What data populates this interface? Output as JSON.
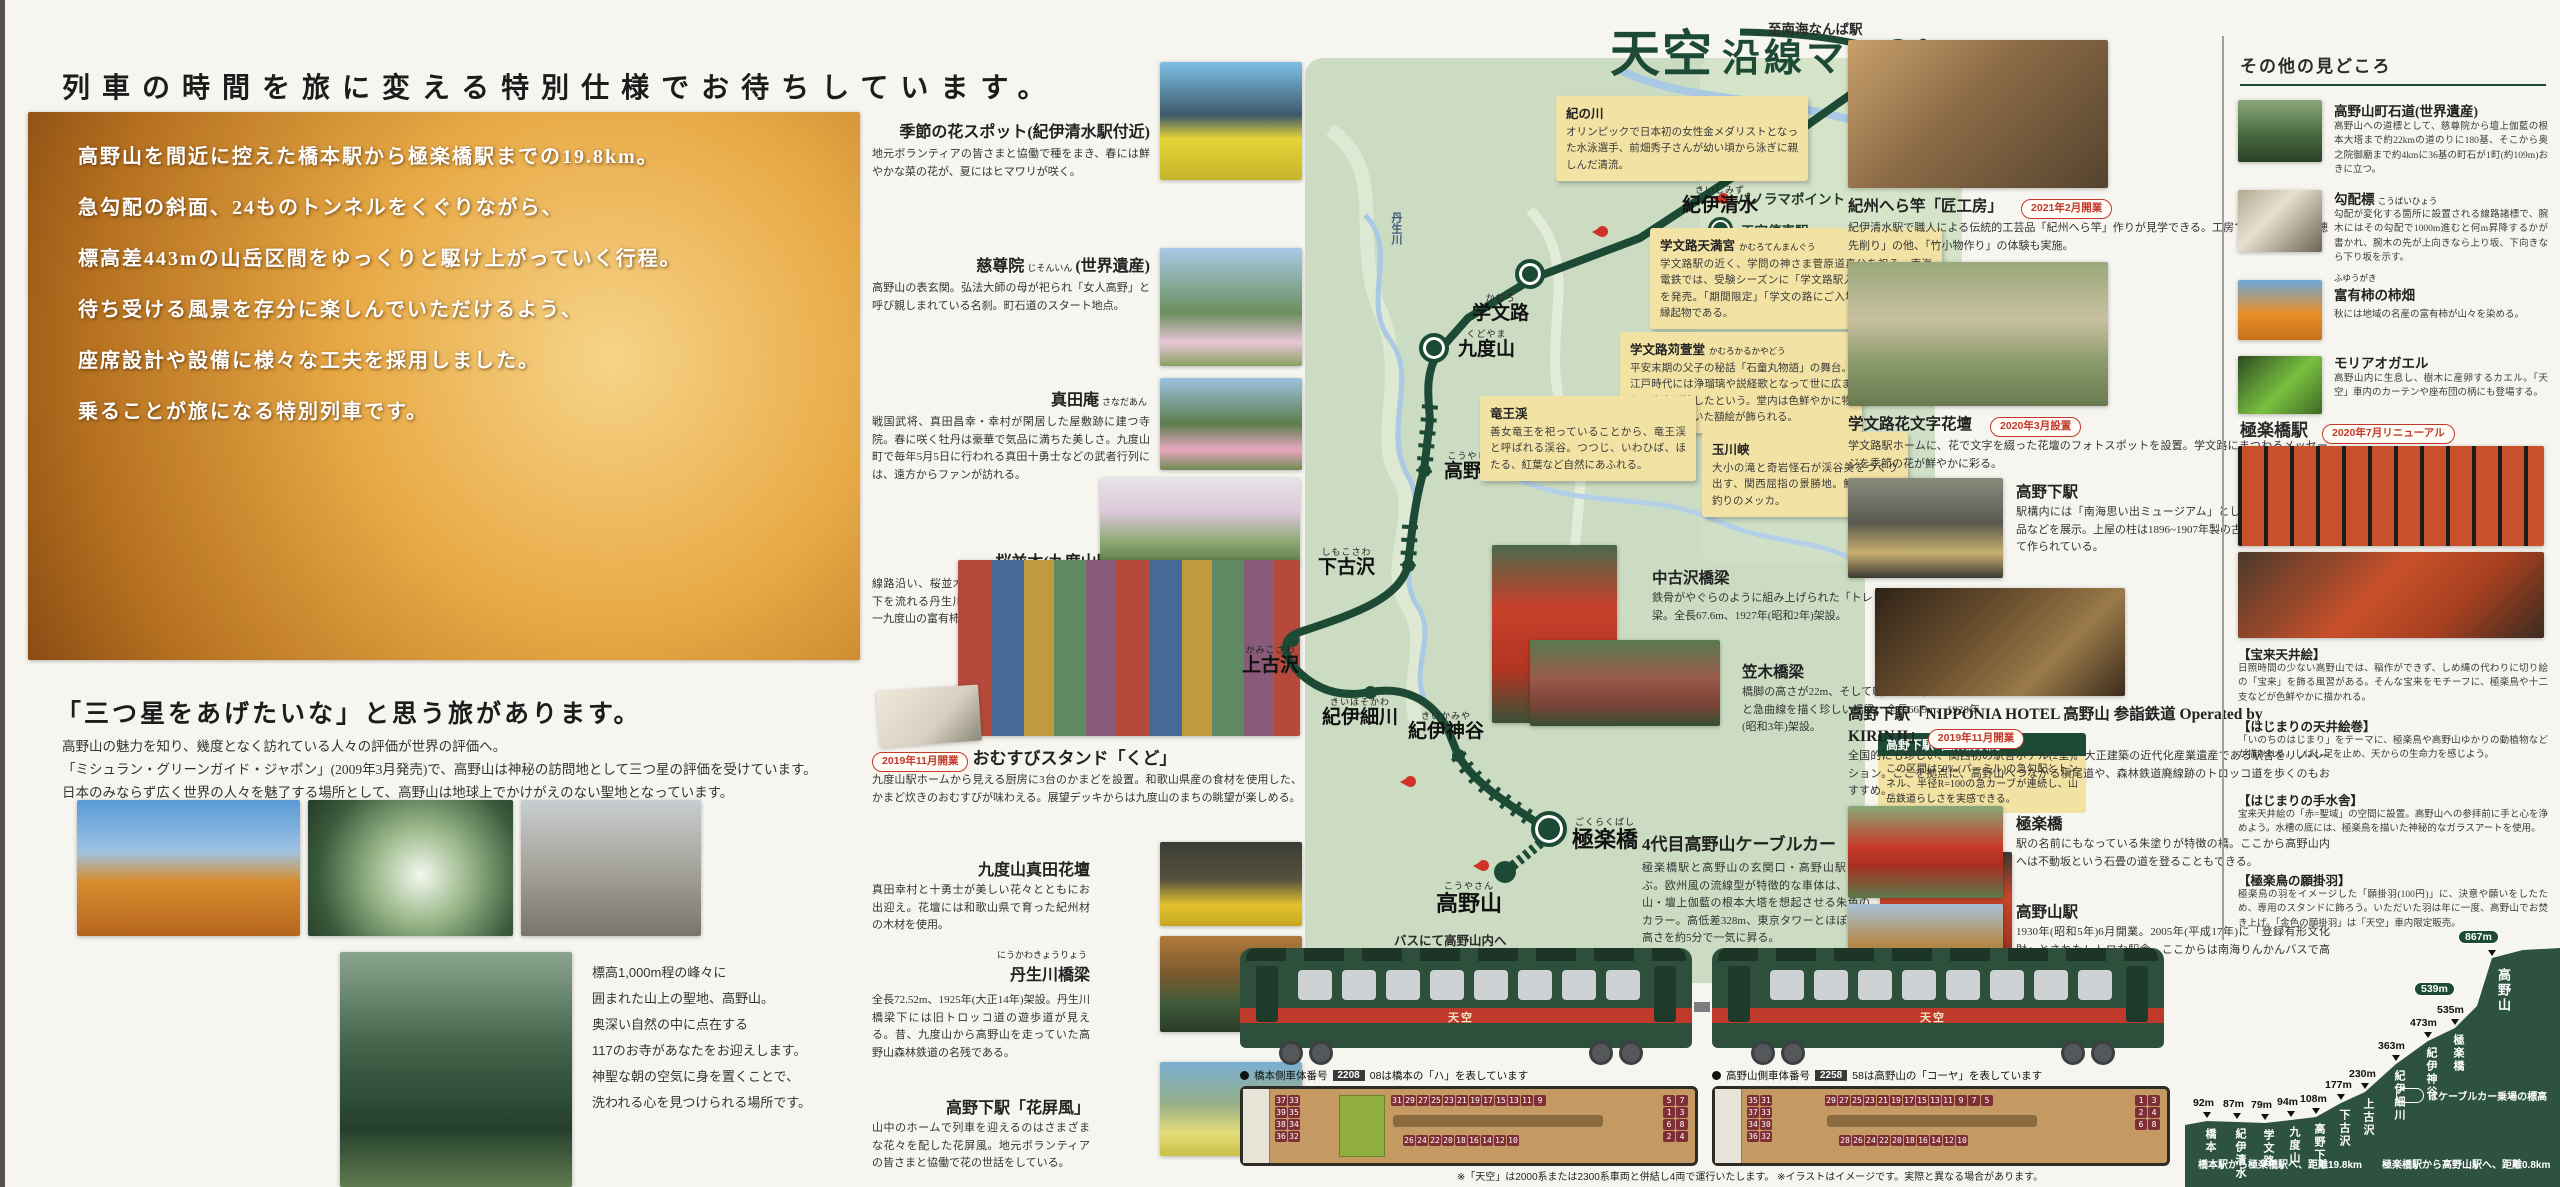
{
  "left": {
    "headline": "列車の時間を旅に変える特別仕様でお待ちしています。",
    "intro_lines": [
      "高野山を間近に控えた橋本駅から極楽橋駅までの19.8km。",
      "急勾配の斜面、24ものトンネルをくぐりながら、",
      "標高差443mの山岳区間をゆっくりと駆け上がっていく行程。",
      "待ち受ける風景を存分に楽しんでいただけるよう、",
      "座席設計や設備に様々な工夫を採用しました。",
      "乗ることが旅になる特別列車です。"
    ],
    "michelin_title": "「三つ星をあげたいな」と思う旅があります。",
    "michelin_lines": [
      "高野山の魅力を知り、幾度となく訪れている人々の評価が世界の評価へ。",
      "「ミシュラン・グリーンガイド・ジャポン」(2009年3月発売)で、高野山は神秘の訪問地として三つ星の評価を受けています。",
      "日本のみならず広く世界の人々を魅了する場所として、高野山は地球上でかけがえのない聖地となっています。"
    ],
    "koyasan_note_lines": [
      "標高1,000m程の峰々に",
      "囲まれた山上の聖地、高野山。",
      "奥深い自然の中に点在する",
      "117のお寺があなたをお迎えします。",
      "神聖な朝の空気に身を置くことで、",
      "洗われる心を見つけられる場所です。"
    ]
  },
  "spots": {
    "items": [
      {
        "kana": "",
        "title": "季節の花スポット(紀伊清水駅付近)",
        "suffix": "",
        "badge": "",
        "body": "地元ボランティアの皆さまと協働で種をまき、春には鮮やかな菜の花が、夏にはヒマワリが咲く。"
      },
      {
        "kana": "じそんいん",
        "title": "慈尊院",
        "suffix": "(世界遺産)",
        "badge": "",
        "body": "高野山の表玄関。弘法大師の母が祀られ「女人高野」と呼び親しまれている名刹。町石道のスタート地点。"
      },
      {
        "kana": "さなだあん",
        "title": "真田庵",
        "suffix": "",
        "badge": "",
        "body": "戦国武将、真田昌幸・幸村が閑居した屋敷跡に建つ寺院。春に咲く牡丹は豪華で気品に満ちた美しさ。九度山町で毎年5月5日に行われる真田十勇士などの武者行列には、遠方からファンが訪れる。"
      },
      {
        "kana": "",
        "title": "桜並木(九度山駅付近)",
        "suffix": "",
        "badge": "",
        "body": "線路沿い、桜並木が車窓をうめ尽くす。眼下を流れる丹生川対岸の町役場には「日本一九度山の富有柿」の看板が見える。"
      },
      {
        "kana": "",
        "title": "おむすびスタンド「くど」",
        "suffix": "",
        "badge": "2019年11月開業",
        "body": "九度山駅ホームから見える厨房に3台のかまどを設置。和歌山県産の食材を使用した、かまど炊きのおむすびが味わえる。展望デッキからは九度山のまちの眺望が楽しめる。"
      },
      {
        "kana": "",
        "title": "九度山真田花壇",
        "suffix": "",
        "badge": "",
        "body": "真田幸村と十勇士が美しい花々とともにお出迎え。花壇には和歌山県で育った紀州材の木材を使用。"
      },
      {
        "kana": "にうかわきょうりょう",
        "title": "丹生川橋梁",
        "suffix": "",
        "badge": "",
        "body": "全長72.52m、1925年(大正14年)架設。丹生川橋梁下には旧トロッコ道の遊歩道が見える。昔、九度山から高野山を走っていた高野山森林鉄道の名残である。"
      },
      {
        "kana": "",
        "title": "高野下駅「花屏風」",
        "suffix": "",
        "badge": "",
        "body": "山中のホームで列車を迎えるのはさまざまな花々を配した花屏風。地元ボランティアの皆さまと協働で花の世話をしている。"
      }
    ]
  },
  "map": {
    "logo": "天空",
    "title": "沿線マップ",
    "to_namba": "至南海なんば駅",
    "river": "丹生川",
    "bus_note": "バスにて高野山内へ",
    "legend": {
      "panorama": "パノラマポイント",
      "station": "天空停車駅",
      "tunnel": "トンネル"
    },
    "stations": [
      {
        "name": "橋本",
        "kana": "はしもと"
      },
      {
        "name": "紀伊清水",
        "kana": "きいしみず"
      },
      {
        "name": "学文路",
        "kana": "かむろ"
      },
      {
        "name": "九度山",
        "kana": "くどやま"
      },
      {
        "name": "高野下",
        "kana": "こうやした"
      },
      {
        "name": "下古沢",
        "kana": "しもこさわ"
      },
      {
        "name": "上古沢",
        "kana": "かみこさわ"
      },
      {
        "name": "紀伊細川",
        "kana": "きいほそかわ"
      },
      {
        "name": "紀伊神谷",
        "kana": "きいかみや"
      },
      {
        "name": "極楽橋",
        "kana": "ごくらくばし"
      },
      {
        "name": "高野山",
        "kana": "こうやさん"
      }
    ],
    "callouts": [
      {
        "title": "紀の川",
        "kana": "",
        "body": "オリンピックで日本初の女性金メダリストとなった水泳選手、前畑秀子さんが幼い頃から泳ぎに親しんだ清流。"
      },
      {
        "title": "学文路天満宮",
        "kana": "かむろてんまんぐう",
        "body": "学文路駅の近く、学問の神さま菅原道真公を祀る。南海電鉄では、受験シーズンに「学文路駅入場券」(5枚入り)を発売。「期間限定」「学文の路にご入場」と語呂のいい縁起物である。"
      },
      {
        "title": "学文路苅萱堂",
        "kana": "かむろかるかやどう",
        "body": "平安末期の父子の秘話「石童丸物語」の舞台。江戸時代には浄瑠璃や説経歌となって世に広まり、大衆が涙したという。堂内は色鮮やかに物語の世界を描いた額絵が飾られる。"
      },
      {
        "title": "竜王渓",
        "kana": "",
        "body": "善女竜王を祀っていることから、竜王渓と呼ばれる渓谷。つつじ、いわひば、ほたる、紅葉など自然にあふれる。"
      },
      {
        "title": "玉川峡",
        "kana": "",
        "body": "大小の滝と奇岩怪石が渓谷美をつくり出す、関西屈指の景勝地。鮎、アマゴ釣りのメッカ。"
      }
    ],
    "section_box": {
      "title": "高野下駅~極楽橋駅間",
      "body": "この区間は50‰(パーミル)の急勾配とトンネル、半径R=100の急カーブが連続し、山岳鉄道らしさを実感できる。"
    },
    "bridges": [
      {
        "title": "中古沢橋梁",
        "body": "鉄骨がやぐらのように組み上げられた「トレッスル式橋脚」の橋梁。全長67.6m、1927年(昭和2年)架設。"
      },
      {
        "title": "笠木橋梁",
        "body": "橋脚の高さが22m、そして軌道が曲線半径R=123と急曲線を描く珍しい橋梁。全長66.9m、1928年(昭和3年)架設。"
      }
    ],
    "cable_car": {
      "badge": "2019年3月デビュー",
      "title": "4代目高野山ケーブルカー",
      "body": "極楽橋駅と高野山の玄関口・高野山駅を結ぶ。欧州風の流線型が特徴的な車体は、高野山・壇上伽藍の根本大塔を想起させる朱色のカラー。高低差328m、東京タワーとほぼ同じ高さを約5分で一気に昇る。"
    }
  },
  "right_col": {
    "items": [
      {
        "title": "紀州へら竿「匠工房」",
        "badge": "2021年2月開業",
        "body": "紀伊清水駅で職人による伝統的工芸品「紀州へら竿」作りが見学できる。工房では「火入れ」「穂先削り」の他、「竹小物作り」の体験も実施。"
      },
      {
        "title": "学文路花文字花壇",
        "badge": "2020年3月設置",
        "body": "学文路駅ホームに、花で文字を綴った花壇のフォトスポットを設置。学文路にまつわるメッセージを季節の花が鮮やかに彩る。"
      },
      {
        "title": "高野下駅",
        "badge": "",
        "body": "駅構内には「南海思い出ミュージアム」として、秘蔵の鉄道部品などを展示。上屋の柱は1896~1907年製の古レールを再利用して作られている。"
      },
      {
        "title": "高野下駅「NIPPONIA HOTEL 高野山 参詣鉄道 Operated by KIRINJI」",
        "badge": "2019年11月開業",
        "body": "全国的にも珍しい、関西初の駅舎ホテル(2室)。大正建築の近代化産業遺産である駅舎をリノベーション。ここを拠点に、高野山へつながる槇尾道や、森林鉄道廃線跡のトロッコ道を歩くのもおすすめ。"
      },
      {
        "title": "極楽橋",
        "badge": "",
        "body": "駅の名前にもなっている朱塗りが特徴の橋。ここから高野山内へは不動坂という石畳の道を登ることもできる。"
      },
      {
        "title": "高野山駅",
        "badge": "",
        "body": "1930年(昭和5年)6月開業。2005年(平成17年)に「登録有形文化財」とされたレトロな駅舎。ここからは南海りんかんバスで高野山内へ。"
      }
    ]
  },
  "misc": {
    "header": "その他の見どころ",
    "items": [
      {
        "title": "高野山町石道(世界遺産)",
        "kana": "",
        "body": "高野山への道標として、慈尊院から壇上伽藍の根本大塔まで約22kmの道のりに180基、そこから奥之院御廟まで約4kmに36基の町石が1町(約109m)おきに立つ。"
      },
      {
        "title": "勾配標",
        "kana": "こうばいひょう",
        "body": "勾配が変化する箇所に設置される線路諸標で、腕木にはその勾配で1000m進むと何m昇降するかが書かれ、腕木の先が上向きなら上り坂、下向きなら下り坂を示す。"
      },
      {
        "title": "富有柿の柿畑",
        "kana": "ふゆうがき",
        "body": "秋には地域の名産の富有柿が山々を染める。"
      },
      {
        "title": "モリアオガエル",
        "kana": "",
        "body": "高野山内に生息し、樹木に産卵するカエル。「天空」車内のカーテンや座布団の柄にも登場する。"
      }
    ],
    "gokurakubashi": {
      "title": "極楽橋駅",
      "badge": "2020年7月リニューアル",
      "sections": [
        {
          "title": "【宝来天井絵】",
          "body": "日照時間の少ない高野山では、稲作ができず、しめ縄の代わりに切り絵の「宝来」を飾る風習がある。そんな宝来をモチーフに、極楽鳥や十二支などが色鮮やかに描かれる。"
        },
        {
          "title": "【はじまりの天井絵巻】",
          "body": "「いのちのはじまり」をテーマに、極楽鳥や高野山ゆかりの動植物などが描かれる。しばし足を止め、天からの生命力を感じよう。"
        },
        {
          "title": "【はじまりの手水舎】",
          "body": "宝来天井絵の「赤=聖域」の空間に設置。高野山への参拝前に手と心を浄めよう。水槽の底には、極楽鳥を描いた神秘的なガラスアートを使用。"
        },
        {
          "title": "【極楽鳥の願掛羽】",
          "body": "極楽鳥の羽をイメージした「願掛羽(100円)」に、決意や願いをしたため、専用のスタンドに飾ろう。いただいた羽は年に一度、高野山でお焚き上げ。「金色の願掛羽」は「天空」車内限定販売。"
        }
      ]
    }
  },
  "train": {
    "logo": "天空",
    "left_caption": {
      "prefix": "橋本側車体番号",
      "badge": "2208",
      "suffix": "08は橋本の「ハ」を表しています"
    },
    "right_caption": {
      "prefix": "高野山側車体番号",
      "badge": "2258",
      "suffix": "58は高野山の「コーヤ」を表しています"
    },
    "seatmap_left": {
      "left_pairs": "37 33 39 35 38 34 36 32",
      "window_row": "31 29 27 25 23 21 19 17 15 13 11 9",
      "mid_row": "26 24 22 20 18 16 14 12 10",
      "right_pairs": "5 7 1 3 6 8 2 4"
    },
    "seatmap_right": {
      "left_pairs": "35 31 37 33 34 30 36 32",
      "window_row": "29 27 25 23 21 19 17 15 13 11 9 7 5",
      "mid_row": "28 26 24 22 20 18 16 14 12 10",
      "right_pairs": "1 3 2 4 6 8"
    },
    "footnote": "※「天空」は2000系または2300系車両と併結し4両で運行いたします。 ※イラストはイメージです。実際と異なる場合があります。"
  },
  "chart_data": {
    "type": "area",
    "title": "天空沿線 標高プロフィール",
    "categories": [
      "橋本",
      "紀伊清水",
      "学文路",
      "九度山",
      "高野下",
      "下古沢",
      "上古沢",
      "紀伊細川",
      "紀伊神谷",
      "極楽橋",
      "高野山"
    ],
    "values": [
      92,
      87,
      79,
      94,
      108,
      177,
      230,
      363,
      473,
      535,
      867
    ],
    "unit": "m",
    "value_labels": [
      "92m",
      "87m",
      "79m",
      "94m",
      "108m",
      "177m",
      "230m",
      "363m",
      "473m",
      "535m"
    ],
    "cable_labels": [
      "539m",
      "867m"
    ],
    "legend_note": "はケーブルカー乗場の標高",
    "distance_notes": [
      "橋本駅から極楽橋駅へ、距離19.8km",
      "極楽橋駅から高野山駅へ、距離0.8km"
    ],
    "xlabel": "",
    "ylabel": "標高",
    "ylim": [
      0,
      900
    ],
    "fill_color": "#2d5240"
  }
}
